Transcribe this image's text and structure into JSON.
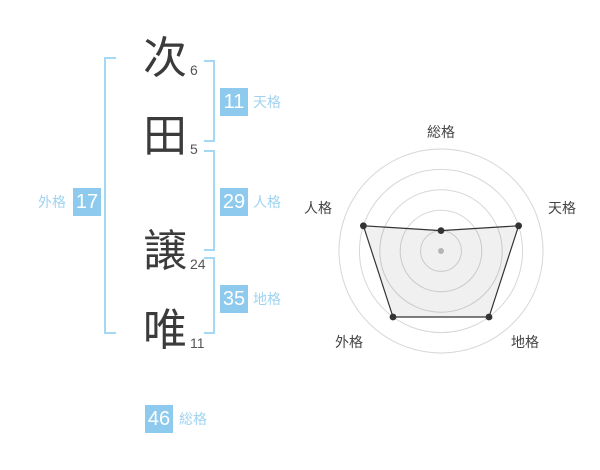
{
  "name": {
    "characters": [
      {
        "char": "次",
        "strokes": "6"
      },
      {
        "char": "田",
        "strokes": "5"
      },
      {
        "char": "譲",
        "strokes": "24"
      },
      {
        "char": "唯",
        "strokes": "11"
      }
    ]
  },
  "kaku": {
    "tenkaku": {
      "value": "11",
      "label": "天格"
    },
    "jinkaku": {
      "value": "29",
      "label": "人格"
    },
    "chikaku": {
      "value": "35",
      "label": "地格"
    },
    "gaikaku": {
      "value": "17",
      "label": "外格"
    },
    "soukaku": {
      "value": "46",
      "label": "総格"
    }
  },
  "colors": {
    "badge_blue": "#8dcaee",
    "label_blue": "#9fd3f1",
    "bracket_blue": "#a5d8f4",
    "kanji_gray": "#3b3b3b",
    "stroke_num_gray": "#555555"
  },
  "chart_data": {
    "type": "radar",
    "axes": [
      "総格",
      "天格",
      "地格",
      "外格",
      "人格"
    ],
    "values": [
      1,
      4,
      4,
      4,
      4
    ],
    "max": 5,
    "rings": 5,
    "grid": "circular",
    "spokes": false,
    "legend_position": "none",
    "grid_color": "#d7d7d7",
    "line_color": "#333333",
    "fill_color": "rgba(0,0,0,0.06)",
    "center_dot_color": "#b5b5b5",
    "label_color": "#444444"
  }
}
